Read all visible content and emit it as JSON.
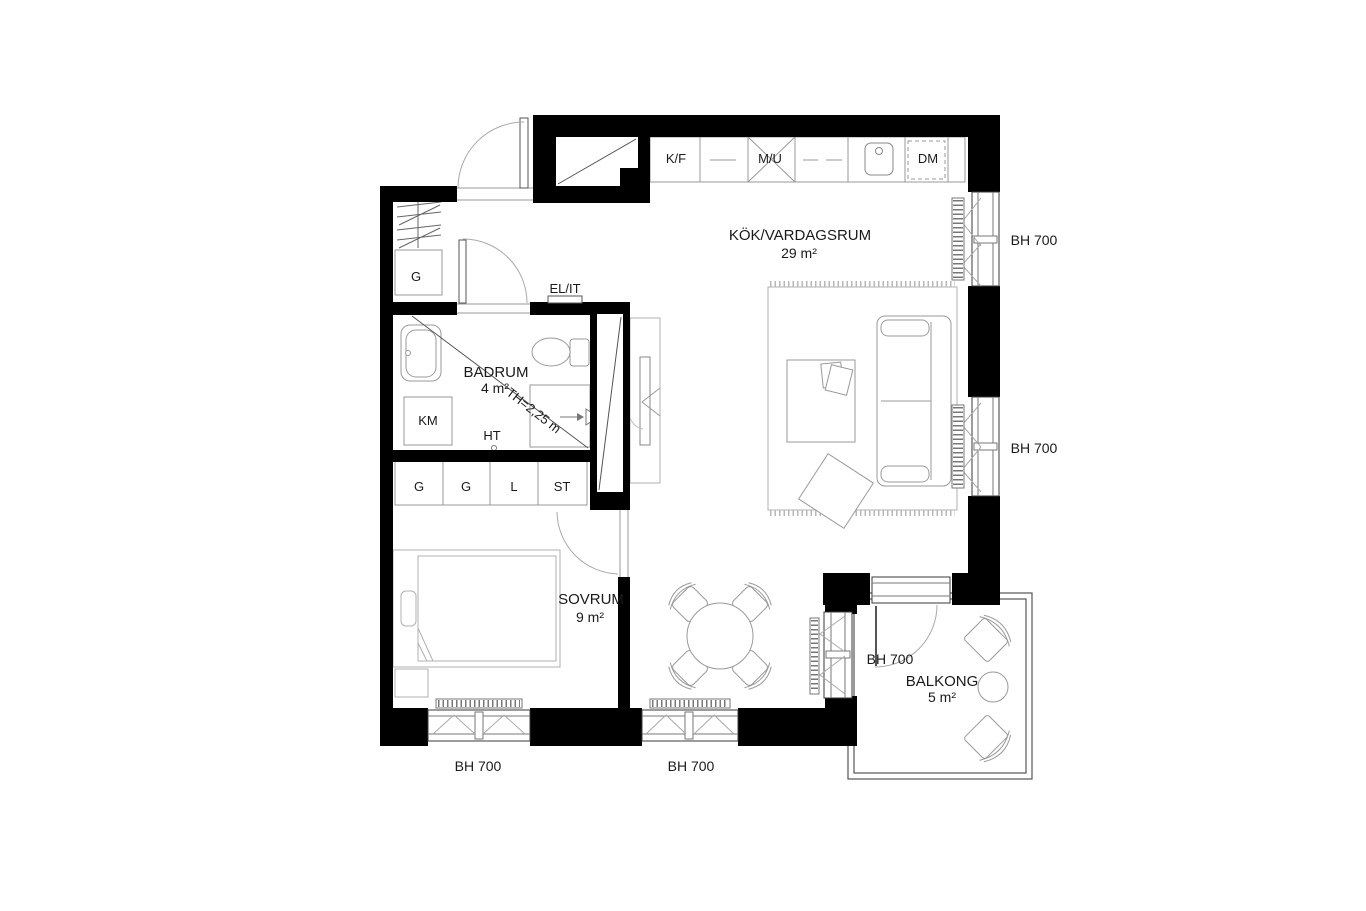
{
  "rooms": {
    "kitchen_living": {
      "name": "KÖK/VARDAGSRUM",
      "area": "29 m²"
    },
    "bedroom": {
      "name": "SOVRUM",
      "area": "9 m²"
    },
    "bathroom": {
      "name": "BADRUM",
      "area": "4 m²"
    },
    "balcony": {
      "name": "BALKONG",
      "area": "5 m²"
    }
  },
  "labels": {
    "window_sill_height": "BH 700",
    "electrical_cabinet": "EL/IT",
    "ceiling_height": "TH=2,25 m",
    "towel_dryer": "HT"
  },
  "kitchen": {
    "fridge_freezer": "K/F",
    "microwave_oven": "M/U",
    "dishwasher": "DM"
  },
  "laundry": {
    "washing_machine": "KM"
  },
  "storage": {
    "hall_wardrobe": "G",
    "wardrobe_1": "G",
    "wardrobe_2": "G",
    "linen_closet": "L",
    "cleaning_closet": "ST"
  },
  "colors": {
    "wall": "#000000",
    "furniture_line": "#b0b0b0",
    "fixture_line": "#999999",
    "window_line": "#3a3a3a",
    "text": "#1a1a1a"
  }
}
